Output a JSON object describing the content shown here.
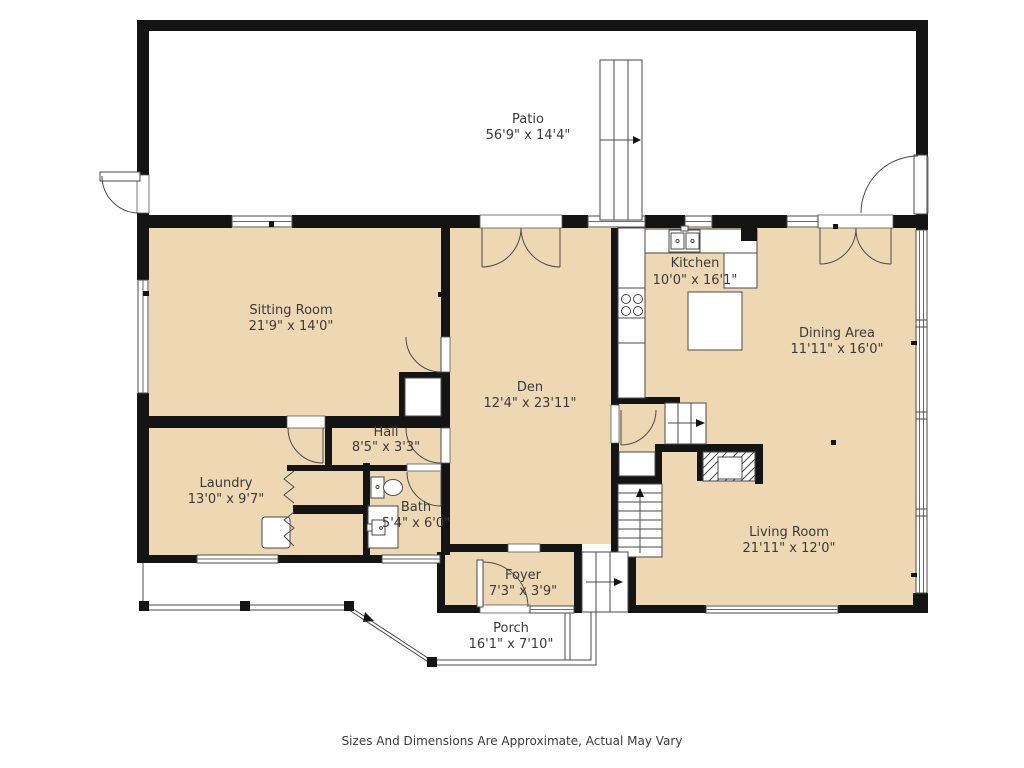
{
  "floorplan": {
    "rooms": [
      {
        "id": "patio",
        "name": "Patio",
        "dims": "56'9\" x 14'4\""
      },
      {
        "id": "sitting-room",
        "name": "Sitting Room",
        "dims": "21'9\" x 14'0\""
      },
      {
        "id": "kitchen",
        "name": "Kitchen",
        "dims": "10'0\" x 16'1\""
      },
      {
        "id": "dining-area",
        "name": "Dining Area",
        "dims": "11'11\" x 16'0\""
      },
      {
        "id": "den",
        "name": "Den",
        "dims": "12'4\" x 23'11\""
      },
      {
        "id": "hall",
        "name": "Hall",
        "dims": "8'5\" x 3'3\""
      },
      {
        "id": "laundry",
        "name": "Laundry",
        "dims": "13'0\" x 9'7\""
      },
      {
        "id": "bath",
        "name": "Bath",
        "dims": "5'4\" x 6'0\""
      },
      {
        "id": "living-room",
        "name": "Living Room",
        "dims": "21'11\" x 12'0\""
      },
      {
        "id": "foyer",
        "name": "Foyer",
        "dims": "7'3\" x 3'9\""
      },
      {
        "id": "porch",
        "name": "Porch",
        "dims": "16'1\" x 7'10\""
      }
    ],
    "disclaimer": "Sizes And Dimensions Are Approximate, Actual May Vary",
    "colors": {
      "room_fill": "#EED8B4",
      "wall": "#141414",
      "line": "#4A4A4A",
      "text": "#3A3A3A",
      "background": "#FFFFFF"
    }
  }
}
